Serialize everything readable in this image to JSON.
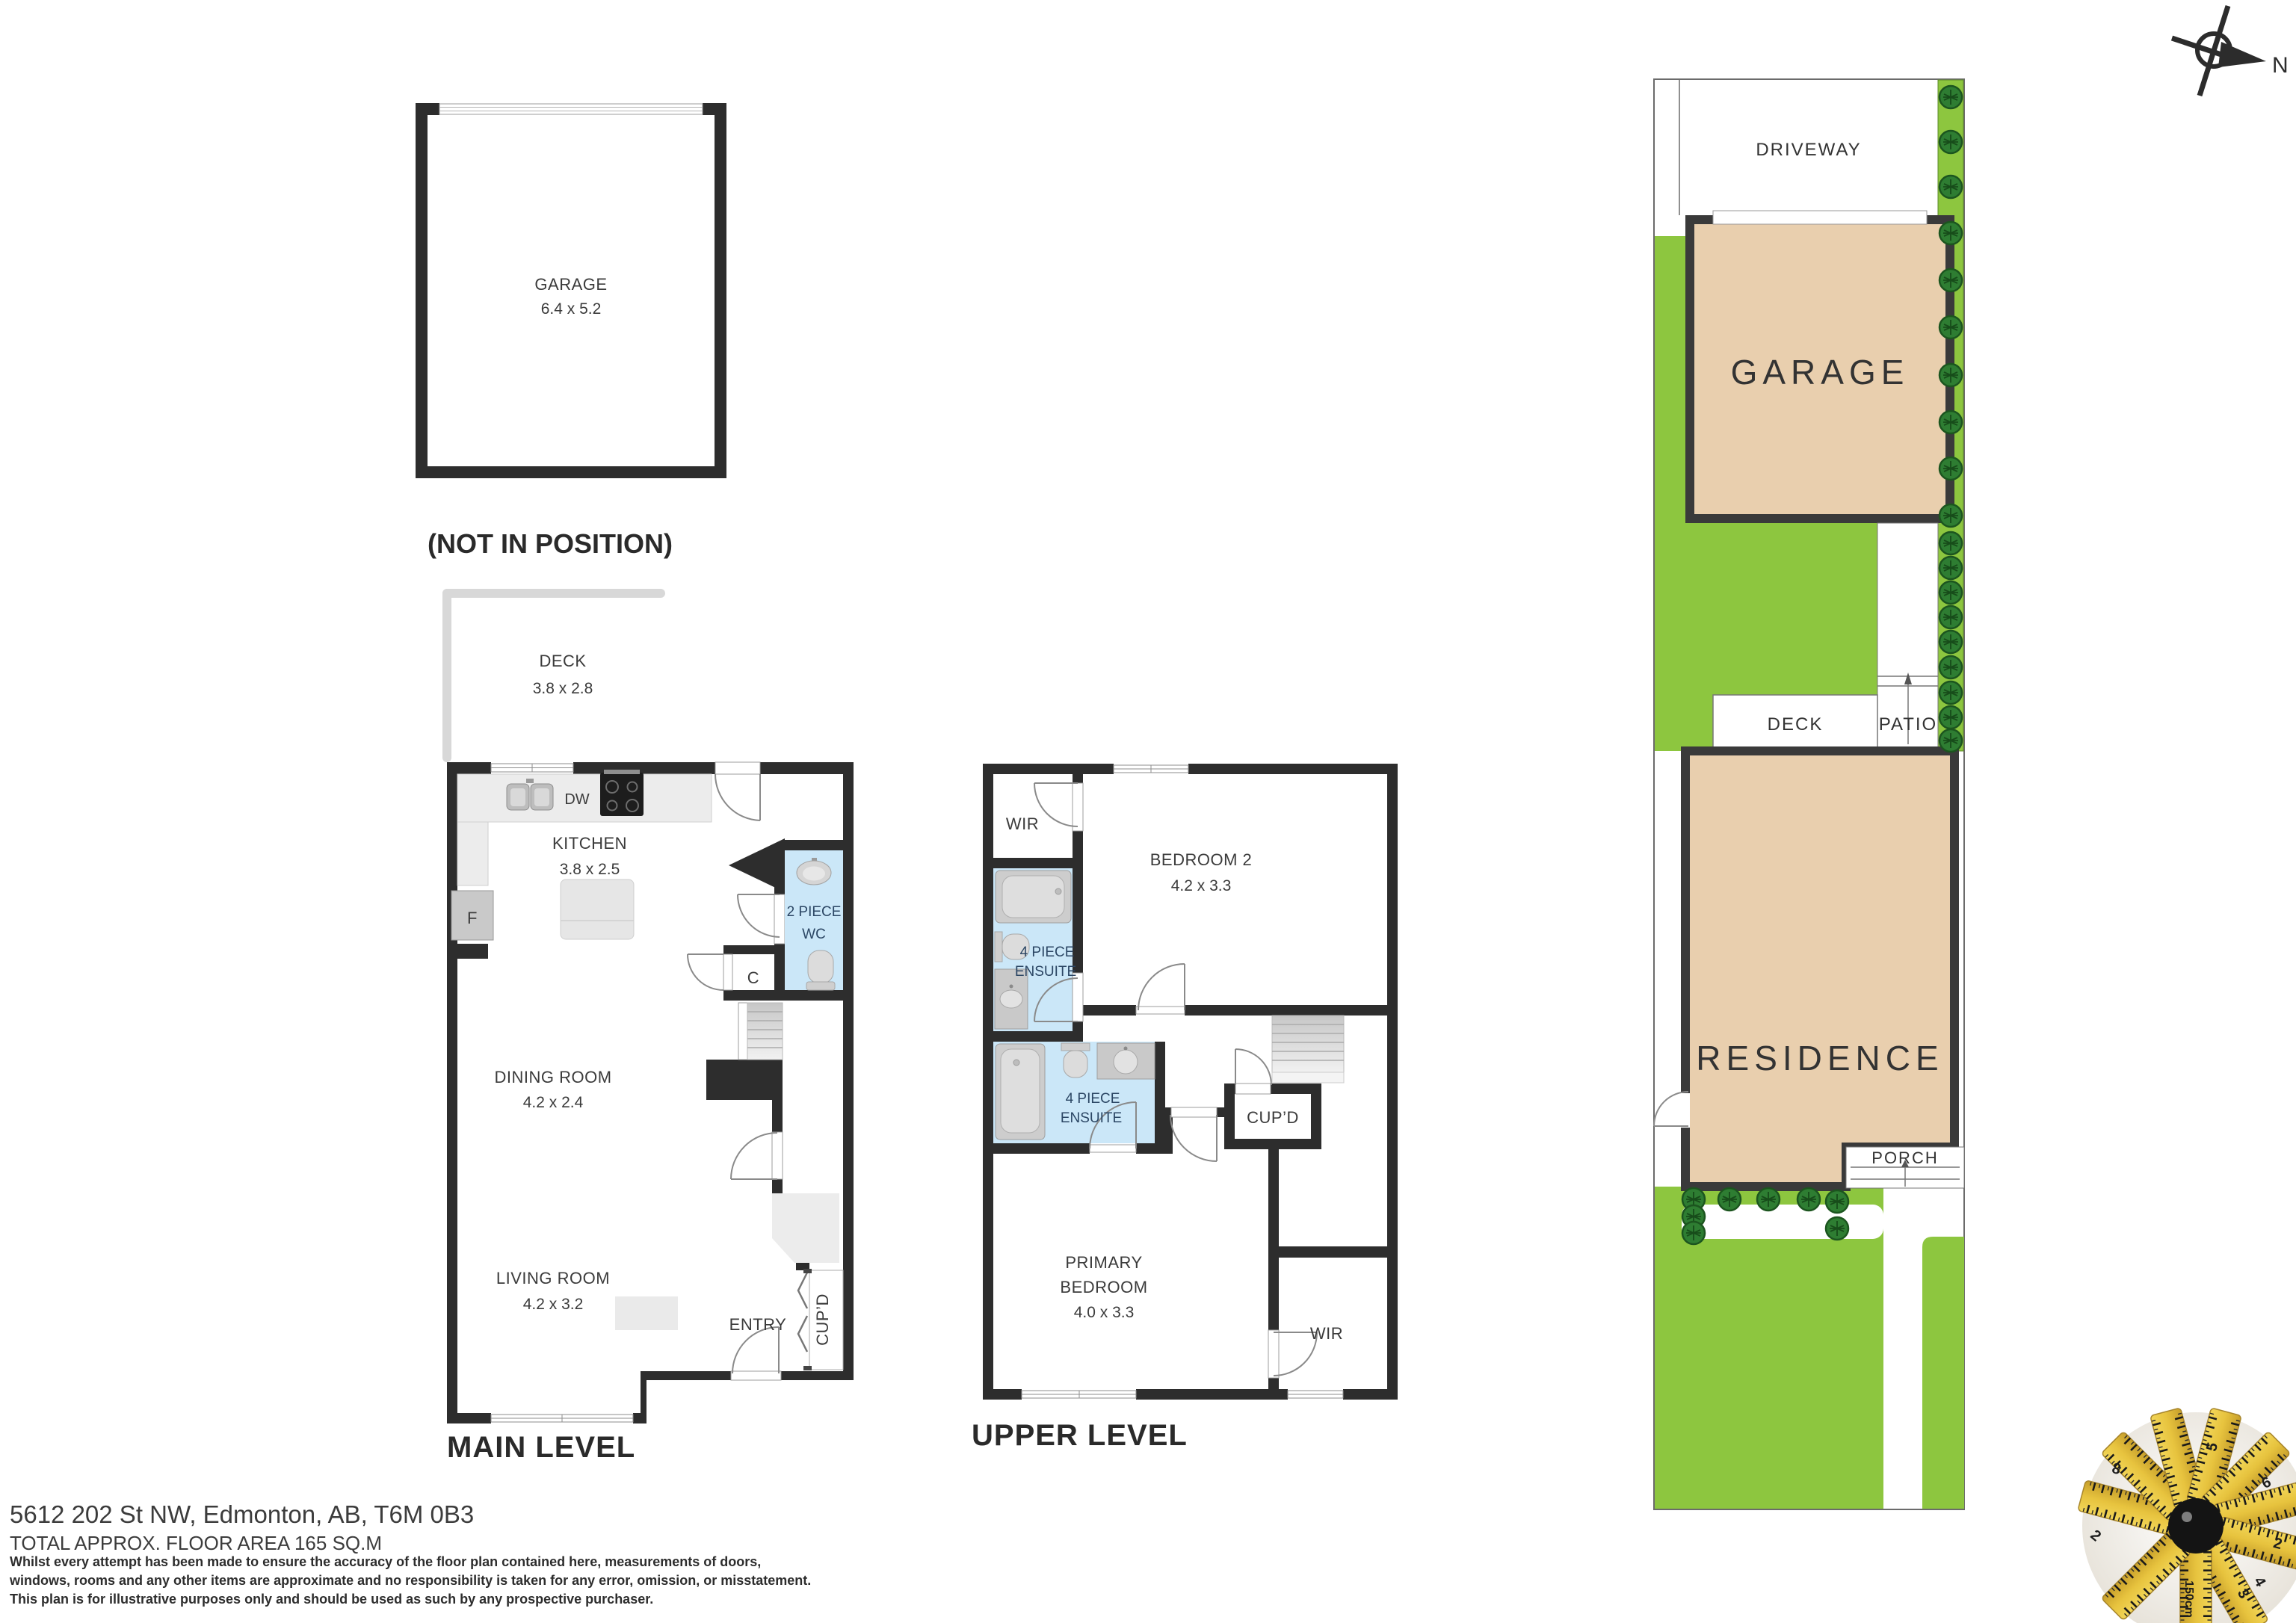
{
  "compass": {
    "north_label": "N"
  },
  "garage_plan": {
    "name": "GARAGE",
    "dims": "6.4 x 5.2",
    "note": "(NOT IN POSITION)"
  },
  "main_level": {
    "title": "MAIN LEVEL",
    "deck": {
      "name": "DECK",
      "dims": "3.8 x 2.8"
    },
    "kitchen": {
      "name": "KITCHEN",
      "dims": "3.8 x 2.5",
      "dishwasher": "DW",
      "fridge": "F"
    },
    "wc": {
      "line1": "2 PIECE",
      "line2": "WC"
    },
    "closet": "C",
    "dining": {
      "name": "DINING ROOM",
      "dims": "4.2 x 2.4"
    },
    "living": {
      "name": "LIVING ROOM",
      "dims": "4.2 x 3.2"
    },
    "entry": "ENTRY",
    "cupboard": "CUP’D"
  },
  "upper_level": {
    "title": "UPPER LEVEL",
    "wir_top": "WIR",
    "bedroom2": {
      "name": "BEDROOM 2",
      "dims": "4.2 x 3.3"
    },
    "ensuite1": {
      "line1": "4 PIECE",
      "line2": "ENSUITE"
    },
    "ensuite2": {
      "line1": "4 PIECE",
      "line2": "ENSUITE"
    },
    "cupboard": "CUP’D",
    "primary": {
      "line1": "PRIMARY",
      "line2": "BEDROOM",
      "dims": "4.0 x 3.3"
    },
    "wir_bottom": "WIR"
  },
  "site_plan": {
    "driveway": "DRIVEWAY",
    "garage": "GARAGE",
    "deck": "DECK",
    "patio": "PATIO",
    "residence": "RESIDENCE",
    "porch": "PORCH"
  },
  "footer": {
    "address": "5612 202 St NW, Edmonton, AB, T6M 0B3",
    "area": "TOTAL APPROX. FLOOR AREA 165 SQ.M",
    "disclaimer1": "Whilst every attempt has been made to ensure the accuracy of the floor plan contained here, measurements of doors,",
    "disclaimer2": "windows, rooms and any other items are approximate and no responsibility is taken for any error, omission, or misstatement.",
    "disclaimer3": "This plan is for illustrative purposes only and should be used as such by any prospective purchaser."
  },
  "logo": {
    "tape_numbers": [
      "8",
      "2",
      "6",
      "5",
      "2",
      "3",
      "4",
      "150cm"
    ]
  },
  "colors": {
    "wall": "#2d2d2d",
    "bath_fill": "#cbe7f8",
    "site_green": "#8dc63f",
    "site_tan": "#e9cfae",
    "bush": "#2e7d32"
  }
}
